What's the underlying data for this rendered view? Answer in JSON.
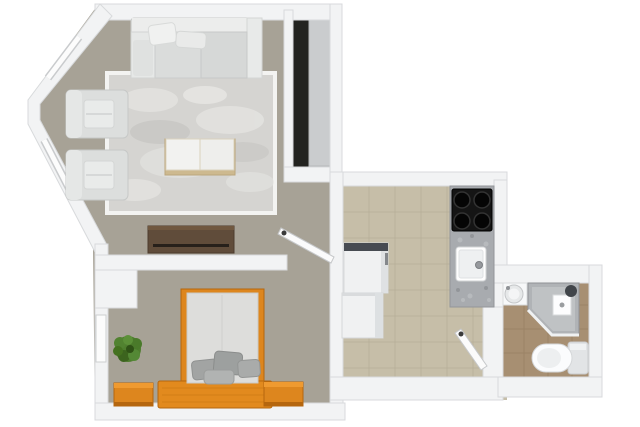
{
  "meta": {
    "description": "3D rendered apartment floor plan, top-down view, no visible text labels"
  },
  "colors": {
    "background": "#ffffff",
    "wall": "#f2f3f4",
    "wall_edge": "#d8dadc",
    "carpet": "#a7a296",
    "rug": "#d5d4d1",
    "rug_border": "#f3f3f1",
    "kitchen_floor": "#c6bea8",
    "kitchen_grid": "#b2aa93",
    "bath_floor": "#a78f72",
    "bath_grid": "#917a5c",
    "closet_floor": "#232320",
    "closet_panel": "#caccce",
    "granite": "#a8abaf",
    "cooktop": "#151515",
    "sofa": "#e2e4e3",
    "armchair": "#dcdedd",
    "table_top": "#f2f2f0",
    "wood_trim": "#cdb98f",
    "dresser": "#604c3a",
    "door": "#fbfbfb",
    "handle": "#3a3a3a",
    "appliance": "#f0f1f2",
    "fridge_top": "#474b52",
    "orange_wood": "#dd861e",
    "orange_dark": "#b5660e",
    "orange_light": "#ef9a30",
    "mattress": "#dddddb",
    "pillow": "#a2a4a3",
    "plant": "#4e7d2e",
    "fixture": "#f7f8f9",
    "shower_glass": "#b0b3b6",
    "toilet_tank": "#e2e4e6",
    "window": "#fcfcfc"
  },
  "rooms": [
    {
      "name": "living-room",
      "floor": "gray carpet with light area rug",
      "items": [
        "sofa",
        "armchair",
        "armchair",
        "coffee-table",
        "area-rug",
        "tv-stand",
        "interior-door",
        "bay-windows"
      ]
    },
    {
      "name": "wardrobe-nook",
      "floor": "dark",
      "items": [
        "wardrobe-panel"
      ]
    },
    {
      "name": "kitchen",
      "floor": "beige tile",
      "items": [
        "refrigerator",
        "washing-machine",
        "granite-countertop",
        "cooktop-4-burners",
        "kitchen-sink",
        "interior-door"
      ]
    },
    {
      "name": "bathroom",
      "floor": "brown tile",
      "items": [
        "washbasin",
        "corner-shower",
        "toilet"
      ]
    },
    {
      "name": "bedroom",
      "floor": "gray carpet",
      "items": [
        "double-bed",
        "pillows",
        "nightstand",
        "nightstand",
        "plant",
        "window"
      ]
    }
  ]
}
